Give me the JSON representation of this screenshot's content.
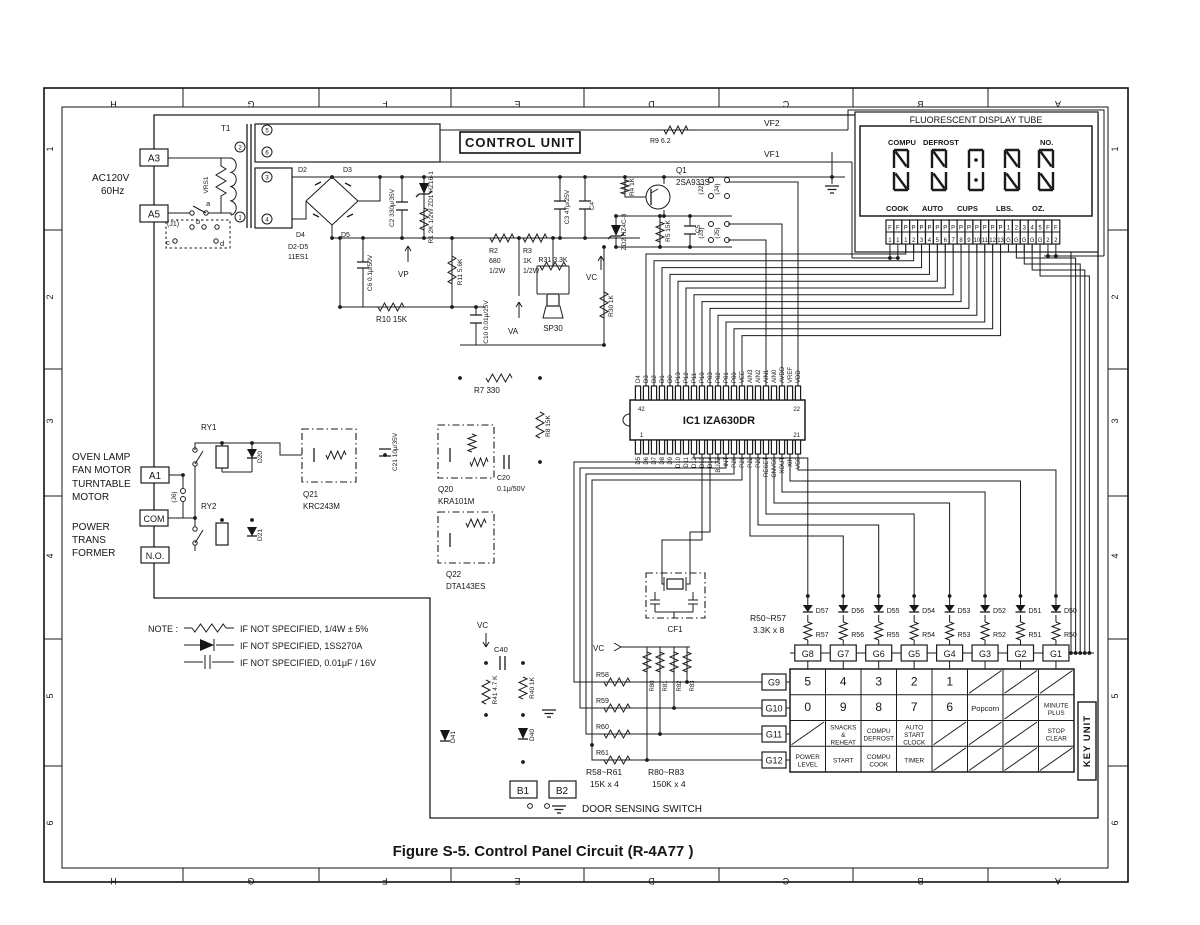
{
  "figure": {
    "caption": "Figure S-5. Control Panel Circuit (R-4A77 )"
  },
  "border": {
    "letters": [
      "H",
      "G",
      "F",
      "E",
      "D",
      "C",
      "B",
      "A"
    ],
    "numbers": [
      "1",
      "2",
      "3",
      "4",
      "5",
      "6"
    ]
  },
  "power": {
    "voltage": "AC120V",
    "frequency": "60Hz",
    "a3": "A3",
    "a5": "A5",
    "vrs1": "VRS1",
    "t1": "T1",
    "j1": "(J1)",
    "contact_a": "a",
    "contact_b": "b",
    "contact_c": "c",
    "contact_d": "d",
    "pin5": "5",
    "pin6": "6",
    "pin2": "2",
    "pin3": "3",
    "pin4": "4",
    "pin1": "1"
  },
  "bridge": {
    "name": "D2-D5",
    "part": "11ES1",
    "d2": "D2",
    "d3": "D3",
    "d4": "D4",
    "d5": "D5"
  },
  "cu": {
    "title": "CONTROL UNIT",
    "r9": "R9 6.2",
    "vf2": "VF2",
    "vf1": "VF1",
    "c2": "C2 330μ/35V",
    "zd1": "ZD1 HZ16-1",
    "r1": "R1 2K 1/2W",
    "c6": "C6 0.1μ/50V",
    "vp": "VP",
    "r10": "R10 15K",
    "r11": "R11 5.6K",
    "c10": "C10 0.01μ/25V",
    "va": "VA",
    "r2": [
      "R2",
      "680",
      "1/2W"
    ],
    "r3": [
      "R3",
      "1K",
      "1/2W"
    ],
    "r31": "R31 3.3K",
    "sp30": "SP30",
    "vc": "VC",
    "r30": "R30 1K",
    "c3": "C3 47μ/25V",
    "c4": "C4",
    "r4": "R4 1K",
    "q1": "Q1",
    "q1_part": "2SA933S",
    "zd2": "ZD2 HZ4C-3",
    "r5": "R5 15K",
    "c5": "C5",
    "j2": "(J2)",
    "j4": "(J4)",
    "j3": "(J3)",
    "j5": "(J5)",
    "r7": "R7 330",
    "r8": "R8 15K"
  },
  "ic": {
    "name": "IC1 IZA630DR",
    "pin_tl": "42",
    "pin_tr": "22",
    "pin_bl": "1",
    "pin_br": "21",
    "top_pins": [
      "D4",
      "D3",
      "D2",
      "D1",
      "D0",
      "P13",
      "P12",
      "P11",
      "P10",
      "P03",
      "P02",
      "P01",
      "P00",
      "VEE",
      "AIN3",
      "AIN2",
      "AIN1",
      "AIN0",
      "AVDD",
      "VREF",
      "VDD"
    ],
    "bottom_pins": [
      "D5",
      "D6",
      "D7",
      "D8",
      "D9",
      "D10",
      "D11",
      "D12",
      "D13",
      "D14",
      "BUZZ",
      "INT",
      "P20",
      "P21",
      "P22",
      "P23",
      "RESET",
      "CNVSS",
      "XOUT",
      "XIN",
      "VSS"
    ]
  },
  "display": {
    "title": "FLUORESCENT DISPLAY TUBE",
    "compu": "COMPU",
    "defrost": "DEFROST",
    "no": "NO.",
    "cook": "COOK",
    "auto": "AUTO",
    "cups": "CUPS",
    "lbs": "LBS.",
    "oz": "OZ.",
    "pin_top": [
      "F",
      "F",
      "P",
      "P",
      "P",
      "P",
      "P",
      "P",
      "P",
      "P",
      "P",
      "P",
      "P",
      "P",
      "P",
      "1",
      "2",
      "3",
      "4",
      "5",
      "F",
      "F"
    ],
    "pin_bottom": [
      "1",
      "1",
      "1",
      "2",
      "3",
      "4",
      "5",
      "6",
      "7",
      "8",
      "9",
      "10",
      "11",
      "12",
      "13",
      "G",
      "G",
      "G",
      "G",
      "G",
      "2",
      "2"
    ]
  },
  "relay": {
    "loads": [
      "OVEN LAMP",
      "FAN MOTOR",
      "TURNTABLE",
      "MOTOR"
    ],
    "a1": "A1",
    "j6": "(J6)",
    "com": "COM",
    "no_terminal": "N.O.",
    "pt": [
      "POWER",
      "TRANS",
      "FORMER"
    ],
    "ry1": "RY1",
    "ry2": "RY2",
    "d20": "D20",
    "d21": "D21",
    "q21": "Q21",
    "q21_part": "KRC243M",
    "c21": "C21 10μ/35V",
    "q20": "Q20",
    "q20_part": "KRA101M",
    "c20": "C20",
    "c20_val": "0.1μ/50V",
    "q22": "Q22",
    "q22_part": "DTA143ES"
  },
  "bottom": {
    "vc": "VC",
    "c40": "C40",
    "r41": "R41 4.7 K",
    "r40": "R40 1K",
    "d41": "D41",
    "d40": "D40",
    "b1": "B1",
    "b2": "B2",
    "door": "DOOR SENSING SWITCH",
    "r58": "R58",
    "r59": "R59",
    "r60": "R60",
    "r61": "R61",
    "r80": "R80",
    "r81": "R81",
    "r82": "R82",
    "r83": "R83",
    "r58_61": [
      "R58~R61",
      "15K x 4"
    ],
    "r80_83": [
      "R80~R83",
      "150K x 4"
    ],
    "cf1": "CF1",
    "vc3": "VC"
  },
  "keys": {
    "unit": "KEY UNIT",
    "r50_57": [
      "R50~R57",
      "3.3K x 8"
    ],
    "diodes": [
      "D57",
      "D56",
      "D55",
      "D54",
      "D53",
      "D52",
      "D51",
      "D50"
    ],
    "resistors": [
      "R57",
      "R56",
      "R55",
      "R54",
      "R53",
      "R52",
      "R51",
      "R50"
    ],
    "g_top": [
      "G8",
      "G7",
      "G6",
      "G5",
      "G4",
      "G3",
      "G2",
      "G1"
    ],
    "g_left": [
      "G9",
      "G10",
      "G11",
      "G12"
    ],
    "matrix": [
      [
        "5",
        "4",
        "3",
        "2",
        "1",
        "",
        "",
        ""
      ],
      [
        "0",
        "9",
        "8",
        "7",
        "6",
        "Popcorn",
        "",
        "MINUTE|PLUS"
      ],
      [
        "",
        "SNACKS|&|REHEAT",
        "COMPU|DEFROST",
        "AUTO|START|CLOCK",
        "",
        "",
        "",
        "STOP|CLEAR"
      ],
      [
        "POWER|LEVEL",
        "START",
        "COMPU|COOK",
        "TIMER",
        "",
        "",
        "",
        ""
      ]
    ]
  },
  "note": {
    "title": "NOTE :",
    "lines": [
      "IF NOT SPECIFIED,  1/4W ± 5%",
      "IF NOT SPECIFIED,  1SS270A",
      "IF NOT SPECIFIED,  0.01μF / 16V"
    ]
  }
}
